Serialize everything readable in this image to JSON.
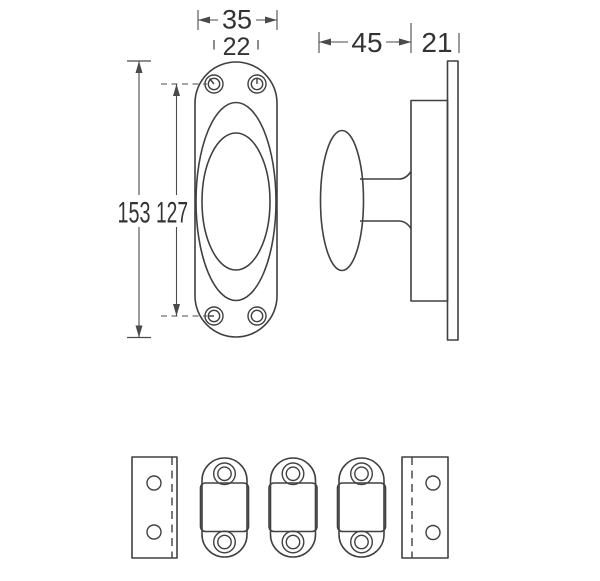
{
  "drawing": {
    "background_color": "#ffffff",
    "line_color": "#404040",
    "dim_line_color": "#4a4a4a",
    "text_color": "#333333",
    "dims": {
      "plate_width": "35",
      "hole_spacing_width": "22",
      "plate_height": "153",
      "hole_spacing_height": "127",
      "knob_projection": "45",
      "base_depth": "21"
    }
  }
}
